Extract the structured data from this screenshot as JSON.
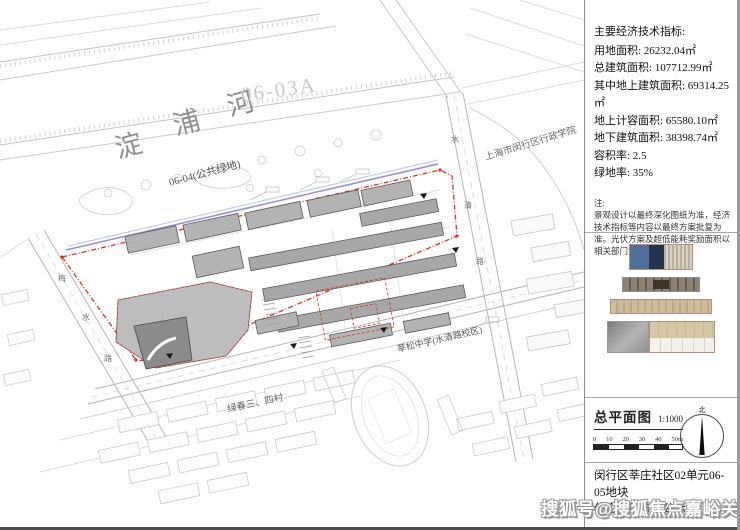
{
  "right_panel": {
    "indicators": {
      "title": "主要经济技术指标:",
      "rows": [
        "用地面积: 26232.04㎡",
        "总建筑面积: 107712.99㎡",
        "其中地上建筑面积: 69314.25㎡",
        "地上计容面积: 65580.10㎡",
        "地下建筑面积: 38398.74㎡",
        "容积率: 2.5",
        "绿地率: 35%"
      ],
      "note_title": "注:",
      "note": "景观设计以最终深化图纸为准，经济技术指标等内容以最终方案批复为准。光伏方案及超低能耗奖励面积以相关部门意见为准。"
    },
    "plan_title": {
      "label": "总平面图",
      "scale": "1:1000"
    },
    "scale_bar": {
      "ticks": [
        "0",
        "10",
        "20",
        "30",
        "40",
        "50m"
      ]
    },
    "north_label": "北",
    "caption_line1": "闵行区莘庄社区02单元06-05地块",
    "caption_line2": "住宅项目方案公示图"
  },
  "map": {
    "river_chars": [
      "淀",
      "浦",
      "河"
    ],
    "parcel_label_0603a": "06-03A",
    "parcel_label_0604": "06-04(公共绿地)",
    "college_label": "上海市闵行区行政学院",
    "school_label": "莘松中学(水清路校区)",
    "village_label": "绿春三、四村",
    "road_right_chars": [
      "水",
      "清",
      "路"
    ],
    "road_left_chars": [
      "梅",
      "水",
      "路"
    ]
  },
  "watermark": "搜狐号@搜狐焦点嘉峪关站",
  "colors": {
    "boundary_red": "#d93025",
    "planning_purple": "#9b8cd8",
    "building_gray": "#b0b0b0",
    "watermark_gray": "#979797"
  }
}
